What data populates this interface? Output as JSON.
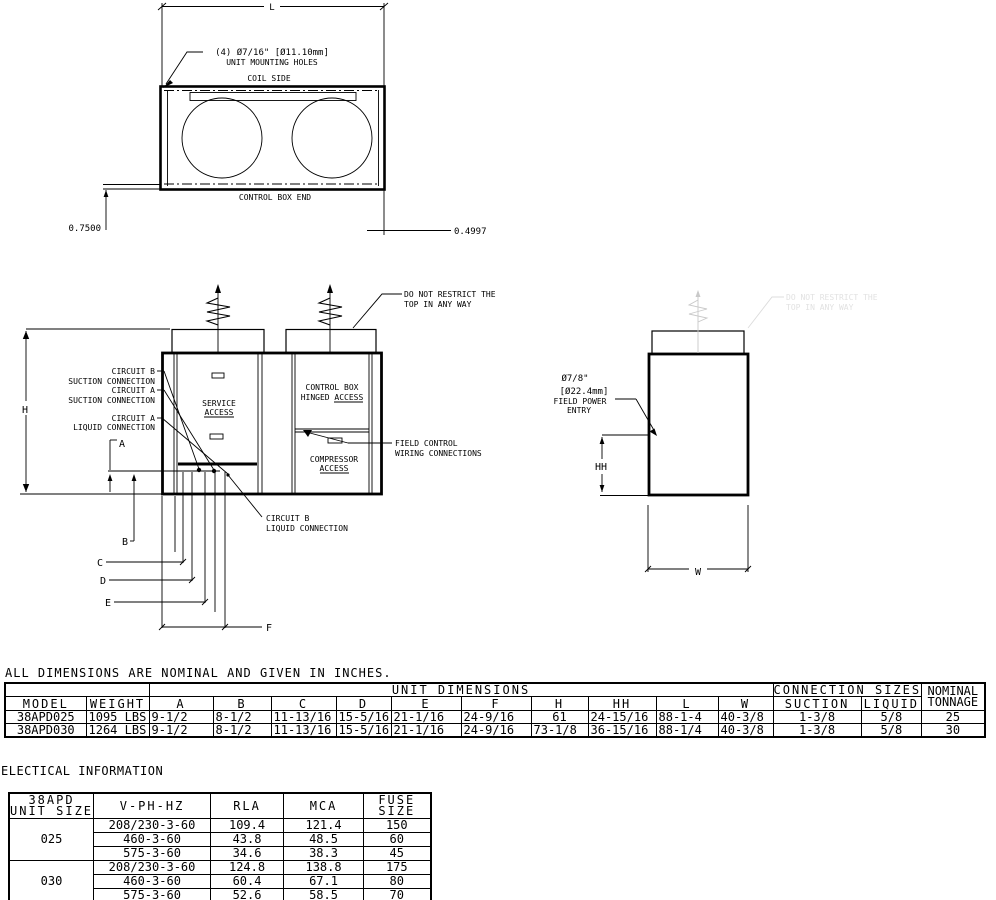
{
  "note": "ALL DIMENSIONS ARE NOMINAL AND GIVEN IN INCHES.",
  "top_view": {
    "dim_l": "L",
    "holes1": "(4) Ø7/16\" [Ø11.10mm]",
    "holes2": "UNIT MOUNTING HOLES",
    "coil_side": "COIL SIDE",
    "control_box_end": "CONTROL BOX END",
    "dim_left": "0.7500",
    "dim_right": "0.4997"
  },
  "front_view": {
    "restrict1": "DO NOT RESTRICT THE",
    "restrict2": "TOP IN ANY WAY",
    "cb_suc1": "CIRCUIT B",
    "cb_suc2": "SUCTION CONNECTION",
    "ca_suc1": "CIRCUIT A",
    "ca_suc2": "SUCTION CONNECTION",
    "ca_liq1": "CIRCUIT A",
    "ca_liq2": "LIQUID CONNECTION",
    "cb_liq1": "CIRCUIT B",
    "cb_liq2": "LIQUID CONNECTION",
    "service1": "SERVICE",
    "service2": "ACCESS",
    "control1": "CONTROL BOX",
    "control2": "HINGED ACCESS",
    "comp1": "COMPRESSOR",
    "comp2": "ACCESS",
    "field1": "FIELD CONTROL",
    "field2": "WIRING CONNECTIONS",
    "dim_h": "H",
    "dim_a": "A",
    "dim_b": "B",
    "dim_c": "C",
    "dim_d": "D",
    "dim_e": "E",
    "dim_f": "F"
  },
  "side_view": {
    "restrict1": "DO NOT RESTRICT THE",
    "restrict2": "TOP IN ANY WAY",
    "power1": "Ø7/8\"",
    "power2": "[Ø22.4mm]",
    "power3": "FIELD POWER",
    "power4": "ENTRY",
    "dim_hh": "HH",
    "dim_w": "W"
  },
  "dim_table": {
    "unit_dimensions": "UNIT DIMENSIONS",
    "connection_sizes": "CONNECTION SIZES",
    "nominal": "NOMINAL",
    "tonnage": "TONNAGE",
    "headers": [
      "MODEL",
      "WEIGHT",
      "A",
      "B",
      "C",
      "D",
      "E",
      "F",
      "H",
      "HH",
      "L",
      "W",
      "SUCTION",
      "LIQUID"
    ],
    "rows": [
      [
        "38APD025",
        "1095 LBS",
        "9-1/2",
        "8-1/2",
        "11-13/16",
        "15-5/16",
        "21-1/16",
        "24-9/16",
        "61",
        "24-15/16",
        "88-1-4",
        "40-3/8",
        "1-3/8",
        "5/8",
        "25"
      ],
      [
        "38APD030",
        "1264 LBS",
        "9-1/2",
        "8-1/2",
        "11-13/16",
        "15-5/16",
        "21-1/16",
        "24-9/16",
        "73-1/8",
        "36-15/16",
        "88-1/4",
        "40-3/8",
        "1-3/8",
        "5/8",
        "30"
      ]
    ]
  },
  "electrical": {
    "title": "ELECTICAL INFORMATION",
    "h_unit1": "38APD",
    "h_unit2": "UNIT SIZE",
    "h_v": "V-PH-HZ",
    "h_rla": "RLA",
    "h_mca": "MCA",
    "h_fuse1": "FUSE",
    "h_fuse2": "SIZE",
    "g1_size": "025",
    "g2_size": "030",
    "g1": [
      [
        "208/230-3-60",
        "109.4",
        "121.4",
        "150"
      ],
      [
        "460-3-60",
        "43.8",
        "48.5",
        "60"
      ],
      [
        "575-3-60",
        "34.6",
        "38.3",
        "45"
      ]
    ],
    "g2": [
      [
        "208/230-3-60",
        "124.8",
        "138.8",
        "175"
      ],
      [
        "460-3-60",
        "60.4",
        "67.1",
        "80"
      ],
      [
        "575-3-60",
        "52.6",
        "58.5",
        "70"
      ]
    ]
  }
}
